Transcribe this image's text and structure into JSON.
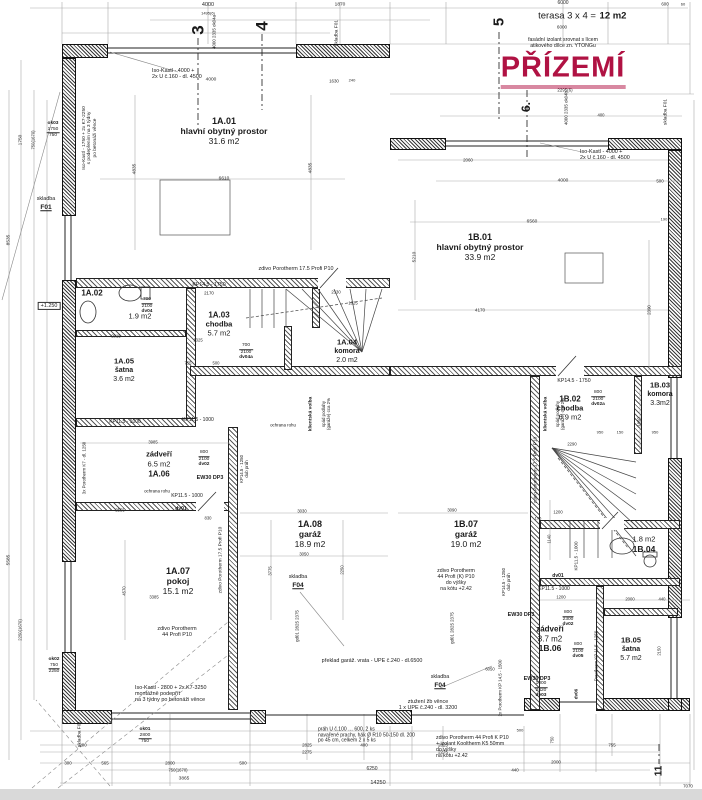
{
  "title": {
    "text": "PŘÍZEMÍ",
    "x": 563,
    "y": 70
  },
  "colors": {
    "accent": "#b01243",
    "ink": "#1a1a1a"
  },
  "marks": [
    {
      "n": "section-mark-3",
      "t": "3",
      "x": 198,
      "y": 30,
      "s": 17
    },
    {
      "n": "section-mark-4",
      "t": "4",
      "x": 262,
      "y": 26,
      "s": 17
    },
    {
      "n": "section-mark-5",
      "t": "5",
      "x": 499,
      "y": 22,
      "s": 15
    },
    {
      "n": "section-mark-6",
      "t": "6.",
      "x": 527,
      "y": 107,
      "s": 12
    },
    {
      "n": "section-mark-11",
      "t": "11",
      "x": 659,
      "y": 771,
      "s": 10
    }
  ],
  "rooms": [
    {
      "id": "1A.01",
      "name": "hlavní obytný prostor",
      "area": "31.6 m2",
      "x": 224,
      "y": 121,
      "s": 9,
      "mode": "std"
    },
    {
      "id": "1B.01",
      "name": "hlavní obytný prostor",
      "area": "33.9 m2",
      "x": 480,
      "y": 237,
      "s": 9,
      "mode": "std"
    },
    {
      "id": "1A.02",
      "name": "",
      "area": "1.9 m2",
      "x": 92,
      "y": 293,
      "s": 8,
      "mode": "noname",
      "ax": 140,
      "ay": 317
    },
    {
      "id": "1A.03",
      "name": "chodba",
      "area": "5.7 m2",
      "x": 219,
      "y": 315,
      "s": 8,
      "mode": "std"
    },
    {
      "id": "1A.04",
      "name": "komora",
      "area": "2.0 m2",
      "x": 347,
      "y": 343,
      "s": 7.5,
      "mode": "std"
    },
    {
      "id": "1A.05",
      "name": "šatna",
      "area": "3.6 m2",
      "x": 124,
      "y": 362,
      "s": 7.5,
      "mode": "std"
    },
    {
      "id": "1A.06",
      "name": "zádveří",
      "area": "6.5 m2",
      "x": 159,
      "y": 455,
      "s": 8,
      "mode": "flip"
    },
    {
      "id": "1A.07",
      "name": "pokoj",
      "area": "15.1 m2",
      "x": 178,
      "y": 571,
      "s": 9,
      "mode": "std"
    },
    {
      "id": "1A.08",
      "name": "garáž",
      "area": "18.9 m2",
      "x": 310,
      "y": 524,
      "s": 9,
      "mode": "std"
    },
    {
      "id": "1B.02",
      "name": "chodba",
      "area": "6.9 m2",
      "x": 570,
      "y": 399,
      "s": 8,
      "mode": "std"
    },
    {
      "id": "1B.03",
      "name": "komora",
      "area": "3.3m2",
      "x": 660,
      "y": 386,
      "s": 7.5,
      "mode": "std"
    },
    {
      "id": "1B.04",
      "name": "",
      "area": "1.8 m2",
      "x": 644,
      "y": 545,
      "s": 8.5,
      "mode": "flip2"
    },
    {
      "id": "1B.05",
      "name": "šatna",
      "area": "5.7 m2",
      "x": 631,
      "y": 641,
      "s": 7.5,
      "mode": "std"
    },
    {
      "id": "1B.06",
      "name": "zádveří",
      "area": "3.7 m2",
      "x": 550,
      "y": 629,
      "s": 8.5,
      "mode": "flip"
    },
    {
      "id": "1B.07",
      "name": "garáž",
      "area": "19.0 m2",
      "x": 466,
      "y": 524,
      "s": 9,
      "mode": "std"
    }
  ],
  "notes": [
    {
      "n": "terasa-label",
      "t": "terasa 3 x 4 =",
      "x": 567,
      "y": 17,
      "s": 9.5
    },
    {
      "n": "terasa-area",
      "t": "12 m2",
      "x": 613,
      "y": 17,
      "s": 9.5,
      "b": 1
    },
    {
      "n": "facade-note",
      "t": "fasádní izolant srovnat s lícem\natikového dílce zn. YTONGu",
      "x": 563,
      "y": 44,
      "s": 5.2
    },
    {
      "n": "iso-kastl-top-note",
      "t": "Iso-Kastl - 4000 +\n2x U č.160 - dl. 4500",
      "x": 152,
      "y": 74,
      "s": 5.4,
      "a": "l"
    },
    {
      "n": "iso-kastl-right-note",
      "t": "Iso-Kastl - 4000 +\n2x U č.160 - dl. 4500",
      "x": 580,
      "y": 155,
      "s": 5.4,
      "a": "l"
    },
    {
      "n": "iso-kastl-left-note",
      "t": "Iso-Kastl - 1750 + 2x K7-2250\ns podepřením na 3 týdny\npo betonáži věnce",
      "x": 90,
      "y": 138,
      "s": 4.8,
      "r": -90
    },
    {
      "n": "iso-kastl-bottom-note",
      "t": "Iso-Kastl - 2800 + 2x K7-3250\nmontážně podepřít\nna 3 týdny po betonáži věnce",
      "x": 135,
      "y": 694,
      "s": 5.4,
      "a": "l"
    },
    {
      "n": "garage-lintel-note",
      "t": "překlad garáž. vrata - UPE č.240 - dl.6500",
      "x": 372,
      "y": 661,
      "s": 5.4
    },
    {
      "n": "ring-beam-note",
      "t": "ztužení žb věnce\n1 x UPE č.240 - dl. 3200",
      "x": 428,
      "y": 705,
      "s": 5.4
    },
    {
      "n": "threshold-note",
      "t": "práh U č.100 … 600, 2 ks\nnavařené prachy, hák Ø R10 50-150 dl. 200\npo 45 cm, celkem 2 x 5 ks",
      "x": 318,
      "y": 736,
      "s": 5,
      "a": "l"
    },
    {
      "n": "porotherm-44k-note",
      "t": "zdivo Porotherm 44 Profi K P10\n+ izolant Kooltherm K5 50mm\ndo výšky\nna kótu +2.42",
      "x": 436,
      "y": 748,
      "s": 5.2,
      "a": "l"
    },
    {
      "n": "porotherm-44k-garage-note",
      "t": "zdivo Porotherm\n44 Profi (K) P10\ndo výšky\nna kótu +2.42",
      "x": 456,
      "y": 581,
      "s": 5.2
    },
    {
      "n": "porotherm-175-note",
      "t": "zdivo Porotherm 17.5 Profi P10",
      "x": 296,
      "y": 269,
      "s": 5.4
    },
    {
      "n": "porotherm-175-note-v1",
      "t": "zdivo Porotherm 17.5 Profi P10",
      "x": 221,
      "y": 560,
      "s": 4.8,
      "r": -90
    },
    {
      "n": "porotherm-175-note-v2",
      "t": "zdivo Porotherm 17.5 Profi P10",
      "x": 536,
      "y": 470,
      "s": 4.8,
      "r": -90
    },
    {
      "n": "porotherm-44-note",
      "t": "zdivo Porotherm\n44 Profi P10",
      "x": 177,
      "y": 632,
      "s": 5.4
    },
    {
      "n": "skladba-f01-left",
      "t": "skladba",
      "x": 46,
      "y": 199,
      "s": 5.4
    },
    {
      "n": "skladba-f01-left-code",
      "t": "F01",
      "x": 46,
      "y": 208,
      "s": 6.6,
      "b": 1,
      "u": 1
    },
    {
      "n": "skladba-f01-top",
      "t": "skladba F01",
      "x": 337,
      "y": 33,
      "s": 4.8,
      "r": -90
    },
    {
      "n": "skladba-f01-right",
      "t": "skladba F01",
      "x": 666,
      "y": 112,
      "s": 4.8,
      "r": -90
    },
    {
      "n": "skladba-f01-bottom",
      "t": "skladba F01",
      "x": 80,
      "y": 734,
      "s": 4.8,
      "r": -90
    },
    {
      "n": "skladba-f04-a",
      "t": "skladba",
      "x": 298,
      "y": 577,
      "s": 5.4
    },
    {
      "n": "skladba-f04-a-code",
      "t": "F04",
      "x": 298,
      "y": 586,
      "s": 6.6,
      "b": 1,
      "u": 1
    },
    {
      "n": "skladba-f04-b",
      "t": "skladba",
      "x": 440,
      "y": 677,
      "s": 5.4
    },
    {
      "n": "skladba-f04-b-code",
      "t": "F04",
      "x": 440,
      "y": 686,
      "s": 6.6,
      "b": 1,
      "u": 1
    },
    {
      "n": "kp145-1750-a",
      "t": "KP14.5 - 1750",
      "x": 209,
      "y": 286,
      "s": 5.2
    },
    {
      "n": "kp145-1750-a2",
      "t": "2170",
      "x": 209,
      "y": 293,
      "s": 4.4
    },
    {
      "n": "kp145-1750-b",
      "t": "KP14.5 - 1750",
      "x": 574,
      "y": 382,
      "s": 5.2
    },
    {
      "n": "kp115-1000-a",
      "t": "KP11.5 - 1000",
      "x": 125,
      "y": 423,
      "s": 5
    },
    {
      "n": "kp115-1000-b",
      "t": "KP11.5 - 1000",
      "x": 198,
      "y": 421,
      "s": 5
    },
    {
      "n": "kp115-1000-c",
      "t": "KP11.5 - 1000",
      "x": 554,
      "y": 590,
      "s": 5
    },
    {
      "n": "kp115-1000-d",
      "t": "KP11.5 - 1000",
      "x": 187,
      "y": 497,
      "s": 5
    },
    {
      "n": "kp115-1000-v",
      "t": "KP11.5 - 1000",
      "x": 576,
      "y": 556,
      "s": 4.6,
      "r": -90
    },
    {
      "n": "kp145-1250-v1",
      "t": "KP14.5 - 1250\ndub práh",
      "x": 244,
      "y": 469,
      "s": 4.4,
      "r": -90
    },
    {
      "n": "kp145-1250-v2",
      "t": "KP14.5 - 1250\ndub práh",
      "x": 506,
      "y": 582,
      "s": 4.4,
      "r": -90
    },
    {
      "n": "ew30-dp3-a",
      "t": "EW30 DP3",
      "x": 210,
      "y": 478,
      "s": 5.4,
      "b": 1
    },
    {
      "n": "ew30-dp3-b",
      "t": "EW30 DP3",
      "x": 521,
      "y": 615,
      "s": 5.4,
      "b": 1
    },
    {
      "n": "ew30-dp3-c",
      "t": "EW30 DP3",
      "x": 537,
      "y": 679,
      "s": 5.4,
      "b": 1
    },
    {
      "n": "klientska-volba-a",
      "t": "klientská volba",
      "x": 311,
      "y": 414,
      "s": 4.8,
      "r": -90,
      "b": 1
    },
    {
      "n": "spad-podlahy-a",
      "t": "spád podlahy\n(garáže) cca 2%",
      "x": 326,
      "y": 414,
      "s": 4.4,
      "r": -90
    },
    {
      "n": "klientska-volba-b",
      "t": "klientská volba",
      "x": 546,
      "y": 414,
      "s": 4.8,
      "r": -90,
      "b": 1
    },
    {
      "n": "spad-podlahy-b",
      "t": "spád podlahy\n(garáže) cca 2%",
      "x": 560,
      "y": 414,
      "s": 4.4,
      "r": -90
    },
    {
      "n": "ochrana-rohu-a",
      "t": "ochrana rohu",
      "x": 283,
      "y": 425,
      "s": 4.4
    },
    {
      "n": "ochrana-rohu-b",
      "t": "ochrana rohu",
      "x": 157,
      "y": 491,
      "s": 4.4
    },
    {
      "n": "porotherm-k7-v",
      "t": "3x Porotherm K7 - dl. 1250",
      "x": 84,
      "y": 468,
      "s": 4.4,
      "r": -90
    },
    {
      "n": "porotherm-kp145-v",
      "t": "2x Porotherm KP 14.5 - 1500",
      "x": 500,
      "y": 688,
      "s": 4.4,
      "r": -90
    },
    {
      "n": "porotherm-kp115-v",
      "t": "Porotherm KP 11.5 - 1250",
      "x": 596,
      "y": 656,
      "s": 4.4,
      "r": -90
    },
    {
      "n": "level-mark",
      "t": "+1.250",
      "x": 49,
      "y": 306,
      "s": 5.4,
      "box": 1
    },
    {
      "n": "ok04a-code",
      "t": "4000  2335  ok04a",
      "x": 214,
      "y": 32,
      "s": 4.4,
      "r": -90
    },
    {
      "n": "ok04b-code",
      "t": "4000  2335  ok04b",
      "x": 566,
      "y": 108,
      "s": 4.4,
      "r": -90
    },
    {
      "n": "gd01-code-a",
      "t": "gd01  2825  2375",
      "x": 297,
      "y": 626,
      "s": 4.4,
      "r": -90
    },
    {
      "n": "gd01-code-b",
      "t": "gd01  2825  2375",
      "x": 452,
      "y": 628,
      "s": 4.4,
      "r": -90
    },
    {
      "n": "dv01-code-a",
      "t": "dv01",
      "x": 181,
      "y": 510,
      "s": 5,
      "b": 1
    },
    {
      "n": "dv01-code-b",
      "t": "dv01",
      "x": 558,
      "y": 577,
      "s": 5,
      "b": 1
    },
    {
      "n": "dv06-code",
      "t": "dv06",
      "x": 576,
      "y": 694,
      "s": 4.6,
      "r": -90,
      "b": 1
    }
  ],
  "codes": [
    {
      "n": "door-dv04",
      "top": "700",
      "bot": "2100",
      "code": "dv04",
      "x": 147,
      "y": 306
    },
    {
      "n": "door-dv04a",
      "top": "700",
      "bot": "2100",
      "code": "dv04a",
      "x": 246,
      "y": 352
    },
    {
      "n": "door-dv02",
      "top": "800",
      "bot": "2100",
      "code": "dv02",
      "x": 204,
      "y": 459
    },
    {
      "n": "door-dv02a",
      "top": "800",
      "bot": "2100",
      "code": "dv02a",
      "x": 598,
      "y": 399
    },
    {
      "n": "door-dv05",
      "top": "800",
      "bot": "2100",
      "code": "dv05",
      "x": 578,
      "y": 651
    },
    {
      "n": "door-dv02-b",
      "top": "800",
      "bot": "2300",
      "code": "dv02",
      "x": 568,
      "y": 619
    },
    {
      "n": "door-dv03",
      "top": "1000",
      "bot": "2420",
      "code": "dv03",
      "x": 541,
      "y": 690
    },
    {
      "n": "window-ok03",
      "top": "1750",
      "bot": "750",
      "code": "ok03",
      "x": 53,
      "y": 130,
      "cf": 1
    },
    {
      "n": "window-ok02",
      "top": "750",
      "bot": "2250",
      "code": "ok02",
      "x": 54,
      "y": 666,
      "cf": 1
    },
    {
      "n": "window-ok01",
      "top": "2800",
      "bot": "750",
      "code": "ok01",
      "x": 145,
      "y": 736,
      "cf": 1
    }
  ],
  "dims": [
    [
      "4000",
      208,
      5,
      0,
      5.5
    ],
    [
      "1495(6)",
      208,
      14,
      0,
      4
    ],
    [
      "1870",
      340,
      5
    ],
    [
      "6000",
      563,
      4,
      0,
      5
    ],
    [
      "600",
      665,
      4,
      0,
      4.4
    ],
    [
      "60",
      683,
      5,
      0,
      4
    ],
    [
      "6000",
      562,
      27,
      0,
      4.6
    ],
    [
      "2295(6)",
      565,
      90,
      0,
      4.4
    ],
    [
      "400",
      601,
      116,
      0,
      4.2
    ],
    [
      "4000",
      563,
      181
    ],
    [
      "500",
      660,
      181,
      0,
      4.4
    ],
    [
      "4000",
      211,
      80
    ],
    [
      "1630",
      334,
      81,
      0,
      4.4
    ],
    [
      "240",
      352,
      81,
      0,
      4
    ],
    [
      "2060",
      468,
      160,
      0,
      4.4
    ],
    [
      "6560",
      532,
      222
    ],
    [
      "6610",
      224,
      179
    ],
    [
      "4835",
      135,
      169,
      -90
    ],
    [
      "4835",
      311,
      168,
      -90
    ],
    [
      "5210",
      415,
      257,
      -90
    ],
    [
      "4170",
      480,
      310,
      0,
      4.6
    ],
    [
      "2390",
      649,
      310,
      -90,
      4.4
    ],
    [
      "2015",
      116,
      337,
      0,
      4.2
    ],
    [
      "1325",
      198,
      341,
      0,
      4.2
    ],
    [
      "755",
      188,
      364,
      0,
      4.2
    ],
    [
      "500",
      216,
      364,
      0,
      4.2
    ],
    [
      "2330",
      336,
      293,
      0,
      4.2
    ],
    [
      "1025",
      353,
      304,
      0,
      4.2
    ],
    [
      "3985",
      153,
      443,
      0,
      4.2
    ],
    [
      "2555",
      120,
      511,
      0,
      4.2
    ],
    [
      "830",
      208,
      519,
      0,
      4.2
    ],
    [
      "3030",
      302,
      512,
      0,
      4.2
    ],
    [
      "3050",
      304,
      555,
      0,
      4.2
    ],
    [
      "3775",
      271,
      571,
      -90,
      4.2
    ],
    [
      "2250",
      343,
      570,
      -90,
      4.2
    ],
    [
      "3385",
      154,
      598,
      0,
      4.2
    ],
    [
      "4570",
      125,
      591,
      -90,
      4.2
    ],
    [
      "1200",
      558,
      513,
      0,
      4.2
    ],
    [
      "3090",
      452,
      511,
      0,
      4.2
    ],
    [
      "1140",
      550,
      539,
      -90,
      4.2
    ],
    [
      "1850",
      640,
      422,
      -90,
      4.2
    ],
    [
      "950",
      600,
      433,
      0,
      4
    ],
    [
      "150",
      620,
      433,
      0,
      4
    ],
    [
      "950",
      655,
      433,
      0,
      4
    ],
    [
      "2290",
      572,
      445,
      0,
      4.2
    ],
    [
      "1200",
      561,
      598,
      0,
      4.2
    ],
    [
      "2000",
      630,
      600,
      0,
      4.2
    ],
    [
      "440",
      662,
      600,
      0,
      4.2
    ],
    [
      "2150",
      660,
      651,
      -90,
      4.2
    ],
    [
      "175",
      538,
      519,
      0,
      4
    ],
    [
      "6050",
      490,
      670,
      0,
      4.2
    ],
    [
      "200",
      83,
      745,
      0,
      4.4
    ],
    [
      "2825",
      307,
      745,
      0,
      4.4
    ],
    [
      "400",
      364,
      745,
      0,
      4.4
    ],
    [
      "2825",
      443,
      745,
      0,
      4.4
    ],
    [
      "755",
      612,
      745,
      0,
      4.4
    ],
    [
      "2275",
      307,
      752,
      0,
      4.4
    ],
    [
      "2275",
      443,
      752,
      0,
      4.4
    ],
    [
      "500",
      520,
      731,
      0,
      4
    ],
    [
      "440",
      515,
      770,
      0,
      4.4
    ],
    [
      "6250",
      372,
      770,
      0,
      5
    ],
    [
      "14250",
      378,
      783,
      0,
      5.5
    ],
    [
      "300",
      68,
      763,
      0,
      4.4
    ],
    [
      "565",
      105,
      763,
      0,
      4.4
    ],
    [
      "2800",
      170,
      763,
      0,
      4.4
    ],
    [
      "500",
      243,
      763,
      0,
      4.4
    ],
    [
      "750(1670)",
      178,
      771,
      0,
      4.2
    ],
    [
      "3865",
      184,
      779,
      0,
      4.8
    ],
    [
      "2000",
      556,
      762,
      0,
      4.4
    ],
    [
      "7070",
      688,
      786,
      0,
      4.4
    ],
    [
      "750",
      553,
      740,
      -90,
      4.2
    ],
    [
      "1750",
      21,
      140,
      -90
    ],
    [
      "750(1670)",
      34,
      140,
      -90,
      4.2
    ],
    [
      "8535",
      9,
      240,
      -90
    ],
    [
      "5585",
      9,
      560,
      -90
    ],
    [
      "2250(1670)",
      21,
      630,
      -90,
      4.2
    ],
    [
      "190",
      664,
      220,
      0,
      4
    ]
  ]
}
